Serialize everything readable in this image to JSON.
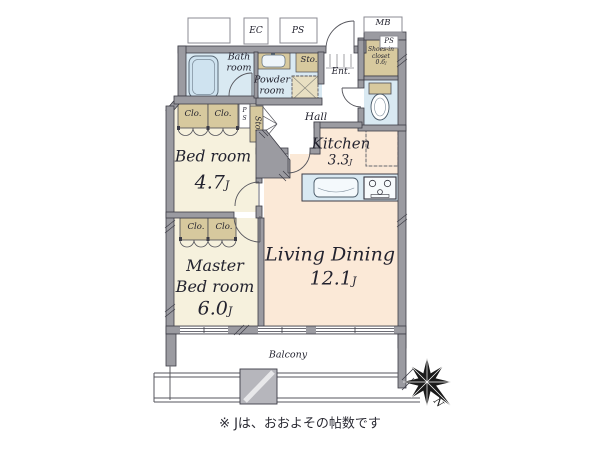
{
  "meta": {
    "footnote": "※ Jは、おおよその帖数です"
  },
  "compass": {
    "north_label": "N"
  },
  "external": {
    "ec_label": "EC",
    "ps_top_label": "PS",
    "mb_label": "MB",
    "ps_right_label": "PS"
  },
  "rooms": {
    "bedroom": {
      "name": "Bed room",
      "size": "4.7",
      "unit": "J"
    },
    "master_bedroom": {
      "name_line1": "Master",
      "name_line2": "Bed room",
      "size": "6.0",
      "unit": "J"
    },
    "living_dining": {
      "name": "Living Dining",
      "size": "12.1",
      "unit": "J"
    },
    "kitchen": {
      "name": "Kitchen",
      "size": "3.3",
      "unit": "J"
    },
    "bath": {
      "name_line1": "Bath",
      "name_line2": "room"
    },
    "powder": {
      "name_line1": "Powder",
      "name_line2": "room"
    },
    "hall": {
      "name": "Hall"
    },
    "entrance": {
      "name": "Ent."
    },
    "balcony": {
      "name": "Balcony"
    },
    "shoes_closet": {
      "name_line1": "Shoes-in",
      "name_line2": "closet",
      "size": "0.6",
      "unit": "J"
    },
    "storage_top": {
      "name": "Sto."
    },
    "storage_hall": {
      "name": "Sto."
    },
    "pipe_space": {
      "letters": [
        "P",
        "S"
      ]
    },
    "closets": [
      "Clo.",
      "Clo.",
      "Clo.",
      "Clo."
    ]
  },
  "colors": {
    "wall": "#9b9ba1",
    "wall_outline": "#3c3c46",
    "water_room": "#d9e9f2",
    "closet": "#d7c99e",
    "bedroom_floor": "#f6f1dd",
    "living_floor": "#fbe9d7",
    "text": "#23232f"
  }
}
